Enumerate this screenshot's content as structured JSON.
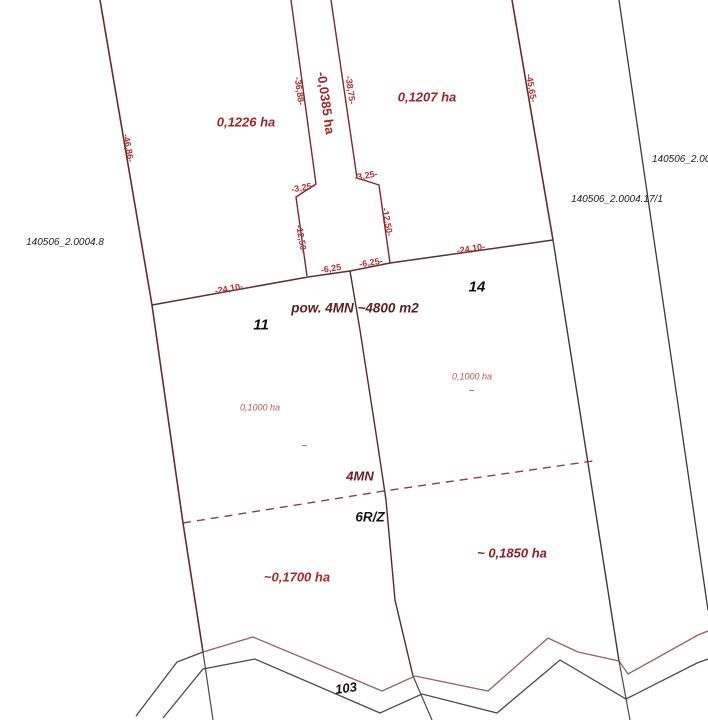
{
  "map": {
    "title": "cadastral parcel division sketch",
    "parcels": {
      "p1226": {
        "area_label": "0,1226 ha"
      },
      "p1207": {
        "area_label": "0,1207 ha"
      },
      "p0385": {
        "area_label": "-0,0385 ha"
      },
      "p11": {
        "number": "11",
        "area_label": "0,1000 ha"
      },
      "p14": {
        "number": "14",
        "area_label": "0,1000 ha"
      },
      "p1700": {
        "area_label": "~0,1700 ha"
      },
      "p1850": {
        "area_label": "~ 0,1850 ha"
      },
      "road": {
        "number": "103"
      }
    },
    "cadastral_ids": {
      "left": "140506_2.0004.8",
      "right_top": "140506_2.0004.1",
      "right_bottom": "140506_2.0004.17/1"
    },
    "annotations": {
      "area_note": "pow. 4MN ~4800 m2",
      "zone_upper": "4MN",
      "zone_lower": "6R/Z"
    },
    "dimensions": {
      "d46_86": "-46,86-",
      "d36_88": "-36,88-",
      "d38_75": "-38,75-",
      "d45_65": "-45,65-",
      "d3_25_left": "-3,25-",
      "d3_25_right": "-3,25-",
      "d12_50_left": "-12,50-",
      "d12_50_right": "-12,50-",
      "d24_10_left": "-24,10-",
      "d24_10_right": "-24,10-",
      "d6_25_left": "-6,25",
      "d6_25_right": "-6,25-"
    },
    "colors": {
      "boundary_red": "#7a2a2a",
      "boundary_dark": "#553333",
      "boundary_black": "#3a3a3a",
      "road_edge_red": "#96625a",
      "road_edge_black": "#4a4a4a",
      "dashed_zone_line": "#8a4040",
      "dim_text_red": "#b03030",
      "area_text_red": "#a02525",
      "area_text_light_red": "#c25555",
      "note_text_maroon": "#5c2020",
      "black_text": "#111111"
    }
  }
}
